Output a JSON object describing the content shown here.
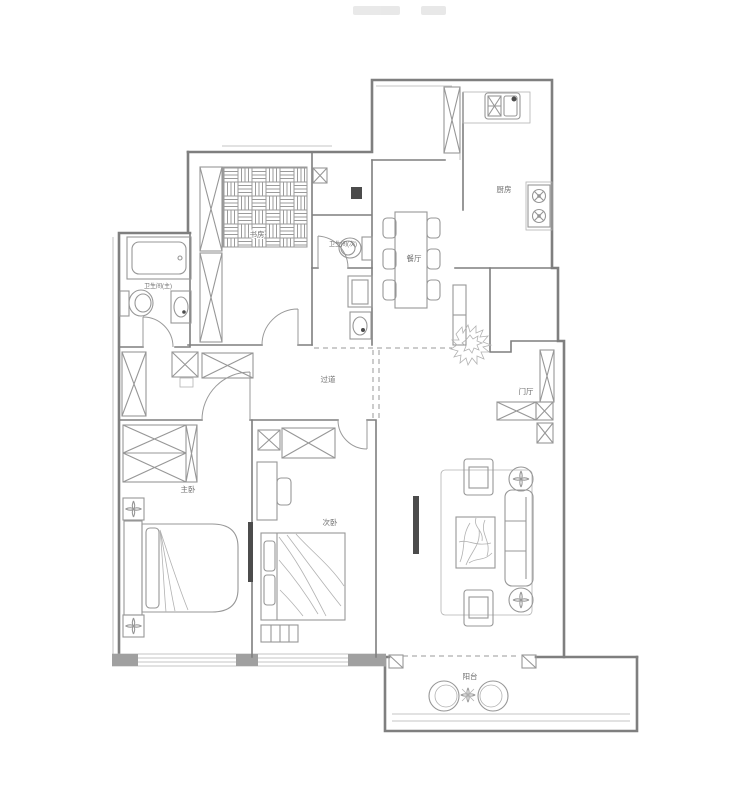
{
  "plan": {
    "type": "apartment-floor-plan"
  },
  "colors": {
    "wall": "#7f7f7f",
    "furniture": "#979797",
    "thin": "#b2b2b2",
    "label": "#6e6e6e",
    "dark": "#4c4c4c",
    "watermark": "#e3e3e3",
    "background": "#ffffff",
    "pier": "#a0a0a0"
  },
  "rooms": {
    "study": {
      "label": "书房"
    },
    "kitchen": {
      "label": "厨房"
    },
    "bath_main": {
      "label": "卫生间(主)"
    },
    "bath_second": {
      "label": "卫生间(次)"
    },
    "dining": {
      "label": "餐厅"
    },
    "corridor": {
      "label": "过道"
    },
    "entry": {
      "label": "门厅"
    },
    "master_bedroom": {
      "label": "主卧"
    },
    "second_bedroom": {
      "label": "次卧"
    },
    "balcony": {
      "label": "阳台"
    }
  }
}
